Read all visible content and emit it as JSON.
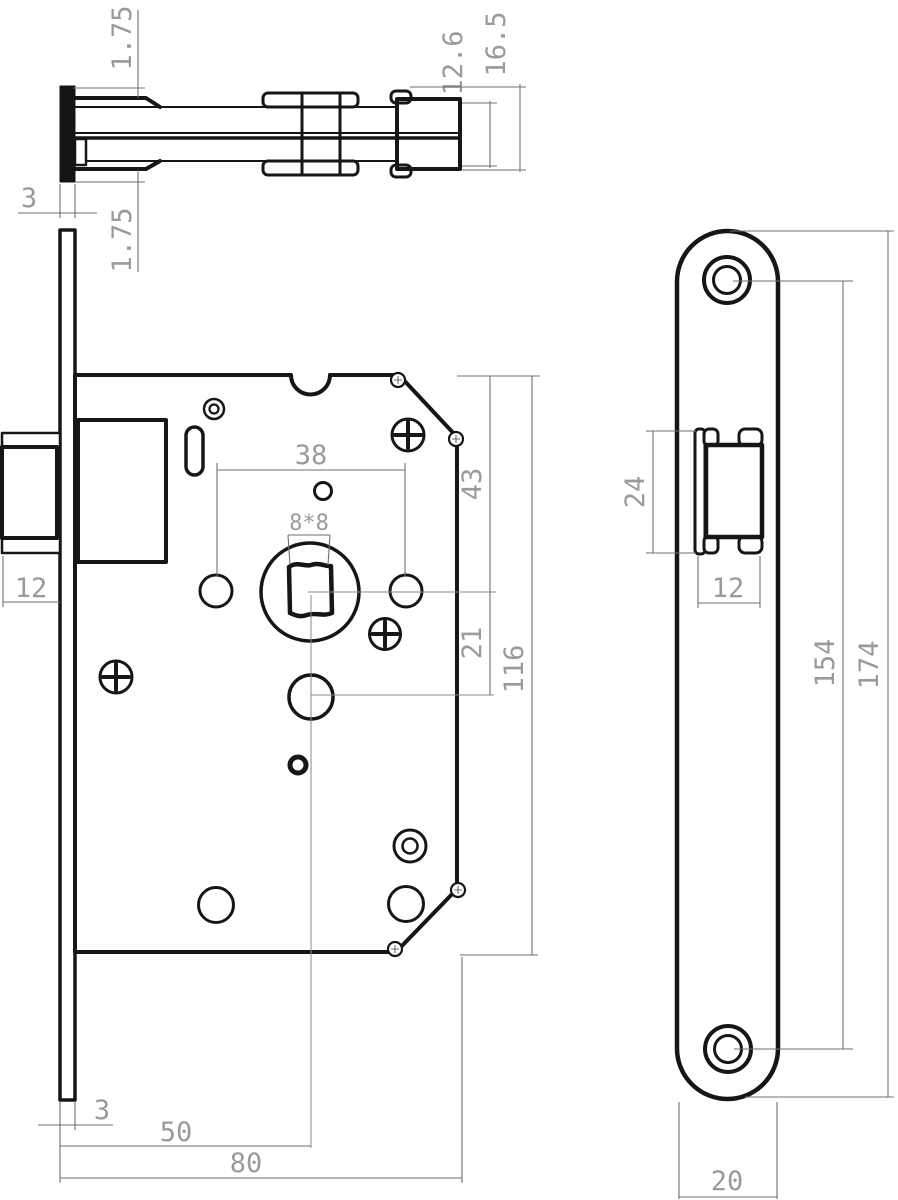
{
  "colors": {
    "background": "#ffffff",
    "part_line": "#161616",
    "dimension_line": "#6f6f6f",
    "dimension_text": "#9a9a9a"
  },
  "labels": {
    "offset_top": "1.75",
    "bolt_head_height": "12.6",
    "bolt_total_height": "16.5",
    "thickness_top": "3",
    "offset_bottom": "1.75",
    "hole_spacing": "38",
    "spindle_square": "8*8",
    "top_to_spindle": "43",
    "spindle_to_hole": "21",
    "case_height": "116",
    "latchbolt_width": "12",
    "thickness_bottom": "3",
    "backset": "50",
    "case_depth": "80",
    "latch_front_height": "24",
    "latch_front_width": "12",
    "screw_spacing": "154",
    "plate_length": "174",
    "plate_width": "20"
  }
}
